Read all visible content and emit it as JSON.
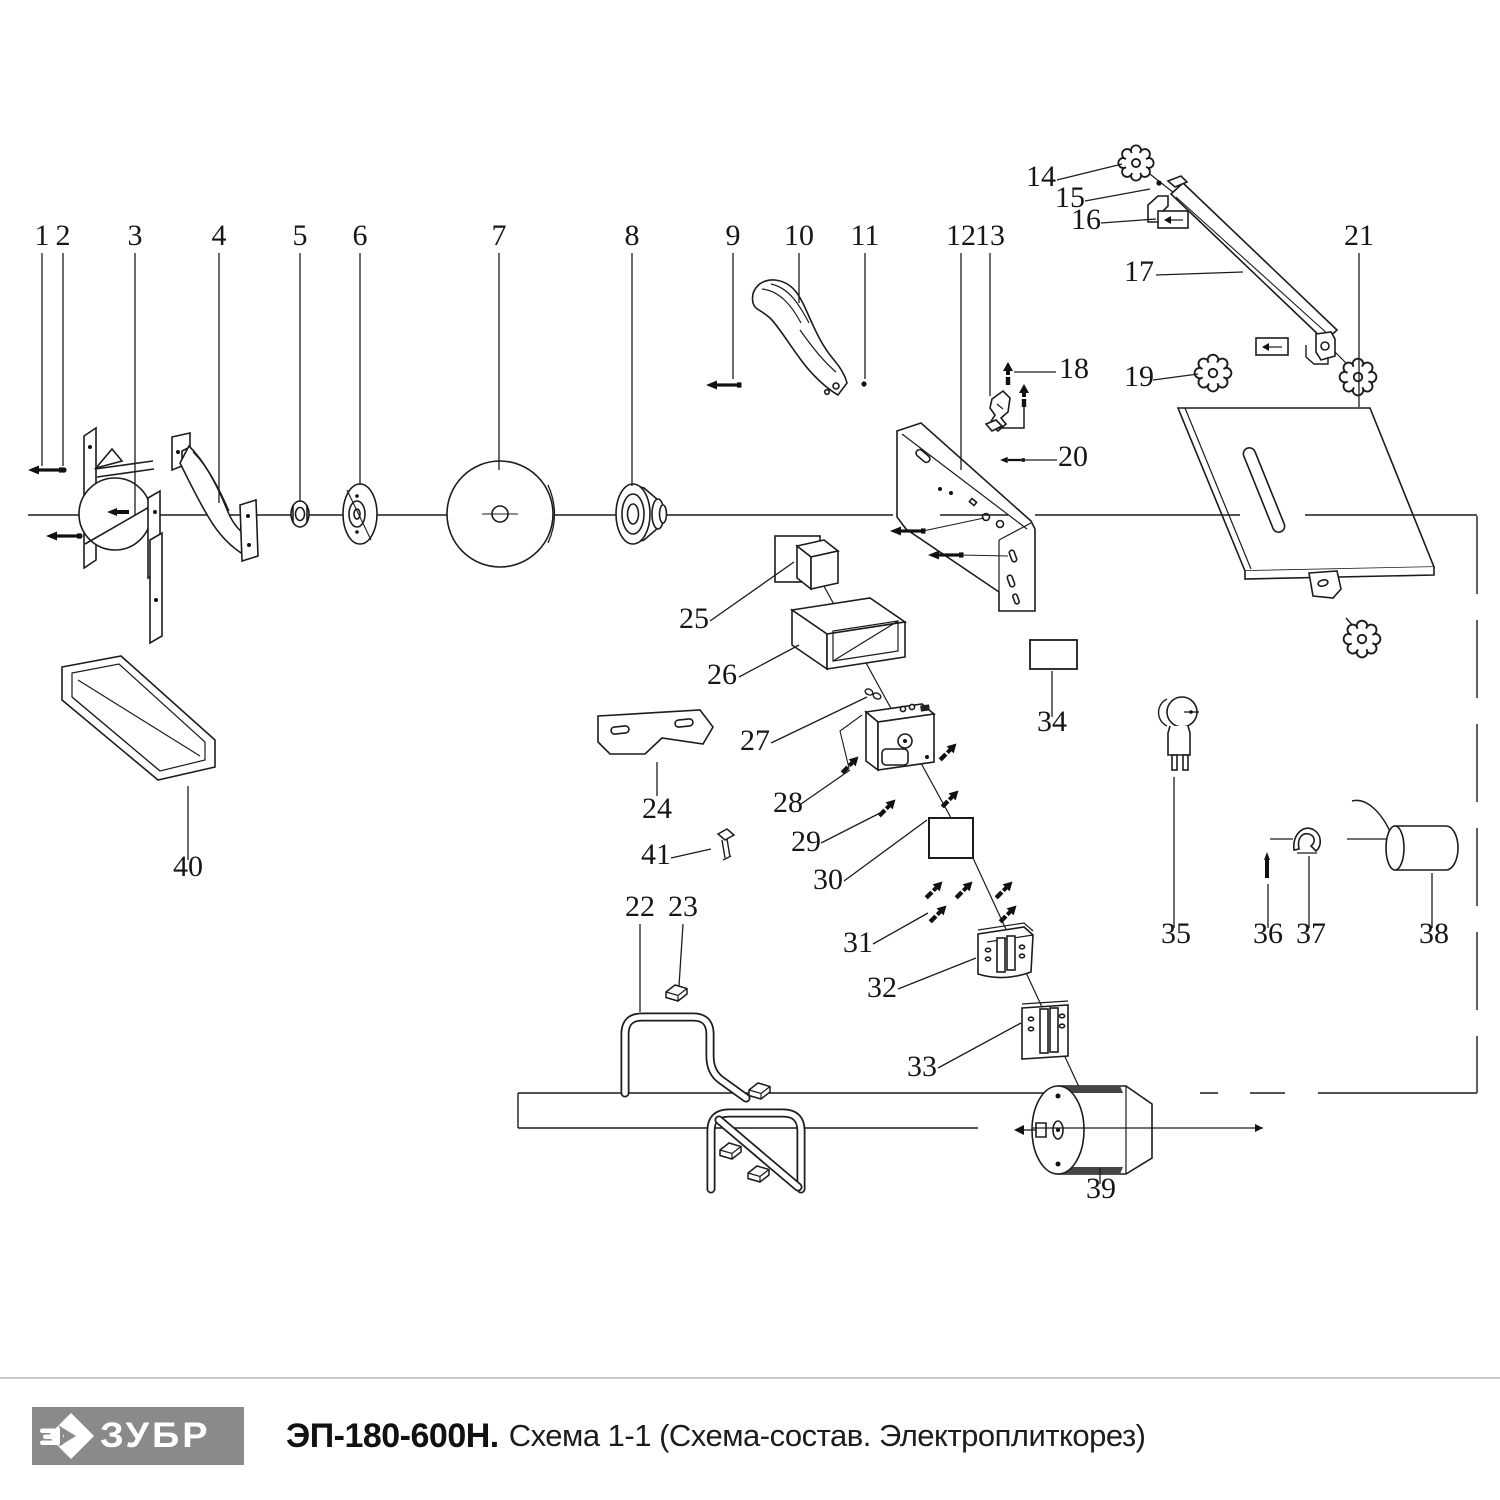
{
  "footer": {
    "brand": "ЗУБР",
    "model": "ЭП-180-600Н.",
    "subtitle": "Схема 1-1 (Схема-состав. Электроплиткорез)"
  },
  "diagram": {
    "labels": [
      "1",
      "2",
      "3",
      "4",
      "5",
      "6",
      "7",
      "8",
      "9",
      "10",
      "11",
      "12",
      "13",
      "14",
      "15",
      "16",
      "17",
      "18",
      "19",
      "20",
      "21",
      "22",
      "23",
      "24",
      "25",
      "26",
      "27",
      "28",
      "29",
      "30",
      "31",
      "32",
      "33",
      "34",
      "35",
      "36",
      "37",
      "38",
      "39",
      "40",
      "41"
    ]
  },
  "colors": {
    "line": "#1c1c1c",
    "logo_bg": "#8a8a8a",
    "logo_text": "#ffffff"
  }
}
